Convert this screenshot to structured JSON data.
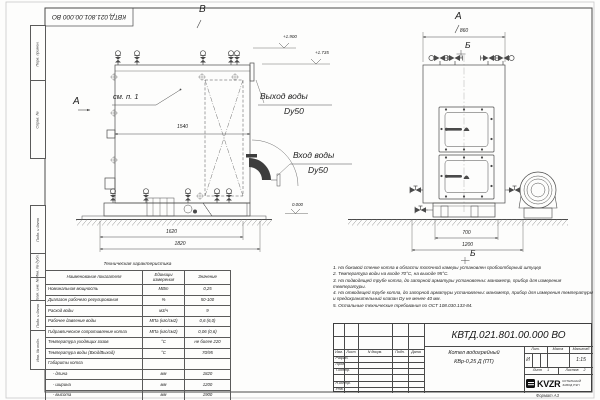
{
  "colors": {
    "ink": "#4a4a4a",
    "logo_black": "#101010"
  },
  "frame": {
    "top_stamp": "КВТД.021.801.00.000 ВО",
    "format_label": "Формат А3",
    "side_labels": [
      "Перв. примен.",
      "Справ. №",
      "Подп. и дата",
      "Инв. № дубл.",
      "Взам. инв. №",
      "Подп. и дата",
      "Инв. № подл."
    ]
  },
  "front_view": {
    "view_label": "В",
    "section_label": "А",
    "callout": "см. п. 1",
    "dim_inner": "1540",
    "dim_base": "1620",
    "dim_overall": "1820",
    "elev_top": "+1.900",
    "elev_mid": "+1.735",
    "elev_zero": "0.000",
    "outlet_title": "Выход воды",
    "outlet_dn": "Dy50",
    "inlet_title": "Вход воды",
    "inlet_dn": "Dy50"
  },
  "side_view": {
    "view_label": "А",
    "section_top": "Б",
    "section_bottom": "Б",
    "dim_top": "860",
    "dim_base": "700",
    "dim_overall": "1200"
  },
  "tech_table": {
    "title": "Техническая характеристика",
    "headers": [
      "Наименование показателя",
      "Единицы измерения",
      "Значение"
    ],
    "rows": [
      [
        "Номинальная мощность",
        "МВт",
        "0,25"
      ],
      [
        "Диапазон рабочего регулирования",
        "%",
        "50-100"
      ],
      [
        "Расход воды",
        "м3/ч",
        "9"
      ],
      [
        "Рабочее давление воды",
        "МПа (кгс/см2)",
        "0,6 (6,0)"
      ],
      [
        "Гидравлическое сопротивление котла",
        "МПа (кгс/см2)",
        "0,06 (0,6)"
      ],
      [
        "Температура уходящих газов",
        "°С",
        "не более 220"
      ],
      [
        "Температура воды (Вход/Выход)",
        "°С",
        "70/95"
      ],
      [
        "Габариты котла",
        "",
        ""
      ],
      [
        "    - длина",
        "мм",
        "1820"
      ],
      [
        "    - ширина",
        "мм",
        "1200"
      ],
      [
        "    - высота",
        "мм",
        "1900"
      ]
    ]
  },
  "notes": [
    "1. На боковой стенке котла в области топочной камеры установлен пробоотборный штуцер",
    "2. Температура воды на входе 70°С, на выходе 95°С.",
    "3. На подводящей трубе котла, до запорной арматуры установлены: манометр, прибор для измерения температуры.",
    "4. На отводящей трубе котла, до запорной арматуры установлены: манометр, прибор для измерения температуры и предохранительный клапан Dу не менее 40 мм.",
    "5. Остальные технические требования по ОСТ 108.030.133-84."
  ],
  "title_block": {
    "doc_number": "КВТД.021.801.00.000 ВО",
    "product_name_line1": "Котел водогрейный",
    "product_name_line2": "КВр-0,25 Д (ПТ)",
    "col_headers": [
      "Изм.",
      "Лист",
      "N докум.",
      "Подп.",
      "Дата"
    ],
    "roles": [
      "Разраб.",
      "Пров.",
      "Т.контр.",
      "Н.контр.",
      "Утв."
    ],
    "lit_header": "Лит.",
    "mass_header": "Масса",
    "scale_header": "Масштаб",
    "lit_value": "И",
    "scale_value": "1:15",
    "sheet_word": "Лист",
    "sheet_num": "1",
    "sheets_word": "Листов",
    "sheets_num": "2",
    "logo_text": "KVZR",
    "company_line1": "КОТЕЛЬНЫЙ",
    "company_line2": "ЗАВОД РЭП"
  }
}
